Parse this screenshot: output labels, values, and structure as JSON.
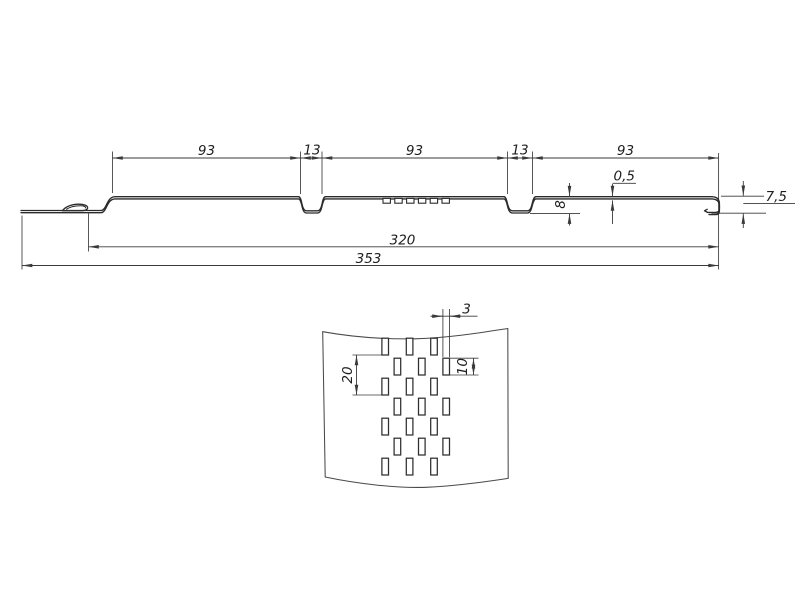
{
  "drawing": {
    "profile_view": {
      "description": "soffit-panel-cross-section",
      "dims": {
        "seg1": "93",
        "seg2": "13",
        "seg3": "93",
        "seg4": "13",
        "seg5": "93",
        "thickness": "0,5",
        "groove_depth": "8",
        "edge_height": "7,5",
        "cover_width": "320",
        "overall_width": "353"
      }
    },
    "detail_view": {
      "description": "perforation-pattern-detail",
      "dims": {
        "slot_width": "3",
        "slot_height": "10",
        "slot_pitch": "20"
      }
    }
  }
}
